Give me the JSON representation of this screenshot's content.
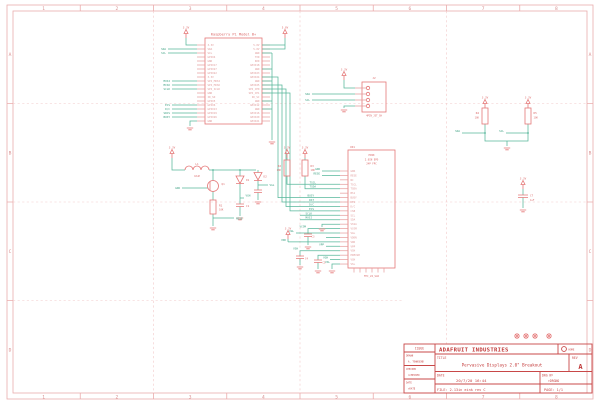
{
  "schematic": {
    "frame": {
      "columns": [
        "1",
        "2",
        "3",
        "4",
        "5",
        "6",
        "7",
        "8"
      ],
      "rows": [
        "A",
        "B",
        "C",
        "D"
      ]
    },
    "power": {
      "v33": "3.3V",
      "v50": "5.0V"
    },
    "rpi": {
      "title": "Raspberry Pi Model B+",
      "pins_left": [
        "3.3V",
        "SDA",
        "SCL",
        "GPIO4",
        "GND",
        "GPIO17",
        "GPIO27",
        "GPIO22",
        "3.3V",
        "SPI_MOSI",
        "SPI_MISO",
        "SPI_SCLK",
        "GND",
        "ID_SD",
        "GPIO5",
        "GPIO6",
        "GPIO13",
        "GPIO19",
        "GPIO26",
        "GND"
      ],
      "pins_right": [
        "5.0V",
        "5.0V",
        "GND",
        "TXD",
        "RXD",
        "GPIO18",
        "GND",
        "GPIO23",
        "GPIO24",
        "GND",
        "GPIO25",
        "SPI_CE0",
        "SPI_CE1",
        "ID_SC",
        "GND",
        "GPIO12",
        "GND",
        "GPIO16",
        "GPIO20",
        "GPIO21"
      ]
    },
    "nets": {
      "sda": "SDA",
      "scl": "SCL",
      "mosi": "MOSI",
      "miso": "MISO",
      "sclk": "SCLK",
      "ecs": "ECS",
      "dc": "D/C",
      "srcs": "SRCS",
      "busy": "BUSY",
      "rst": "RST",
      "gdr": "GDR",
      "rese": "RESE",
      "tscl": "TSCL",
      "tsda": "TSDA",
      "vcom": "VCOM",
      "vgl": "VGL",
      "vdd": "VDD",
      "vpp": "VPP",
      "vsh": "VSH",
      "vgh": "VGH",
      "vsl": "VSL"
    },
    "components": {
      "l1": "L1",
      "l1_value": "10uH",
      "q1": "Q1",
      "r1": "R1",
      "r2": "R2",
      "r3": "R3",
      "r4": "R4",
      "r5": "R5",
      "r_value": "10K",
      "d1": "D1",
      "d2": "D2",
      "c1": "C1",
      "c3": "C3",
      "c4": "C4",
      "c5": "C5",
      "c7": "C7",
      "c_value": "1uF"
    },
    "jst": {
      "refdes": "J2",
      "value": "4PIN_JST_SH"
    },
    "eink": {
      "refdes": "CN1",
      "value": "FPC_24_SLR",
      "header": [
        "EINK",
        "2.0IN EPD",
        "24P FPC"
      ],
      "pins": [
        "GDR",
        "RESE",
        "NC",
        "TSCL",
        "TSDA",
        "BS1",
        "BUSY",
        "RES",
        "D/C",
        "CSB",
        "SCL",
        "SDA",
        "VSSA",
        "VCOM",
        "VGL",
        "VDDN",
        "VDD",
        "VPP",
        "VSH",
        "PREVGH",
        "VGH",
        "VSL"
      ]
    },
    "title_block": {
      "issue_label": "ISSUE",
      "company": "ADAFRUIT INDUSTRIES",
      "logo_label": "HOME",
      "drawn_label": "DRAWN",
      "drawn_value": "A. TOWNSEND",
      "checked_label": "CHECKED",
      "checked_value": ">CHECKED",
      "date_small_label": "DATE",
      "date_small_value": ">DATE",
      "title_label": "TITLE",
      "title_value": "Pervasive Displays 2.0\" Breakout",
      "rev_label": "REV",
      "rev_value": "A",
      "date_label": "DATE",
      "date_value": "20/7/20 16:44",
      "drg_label": "DRG Nº",
      "drg_value": ">DRGNO",
      "file_value": "FILE: 2.13in eink rev C",
      "page_value": "PAGE: 1/1"
    }
  }
}
